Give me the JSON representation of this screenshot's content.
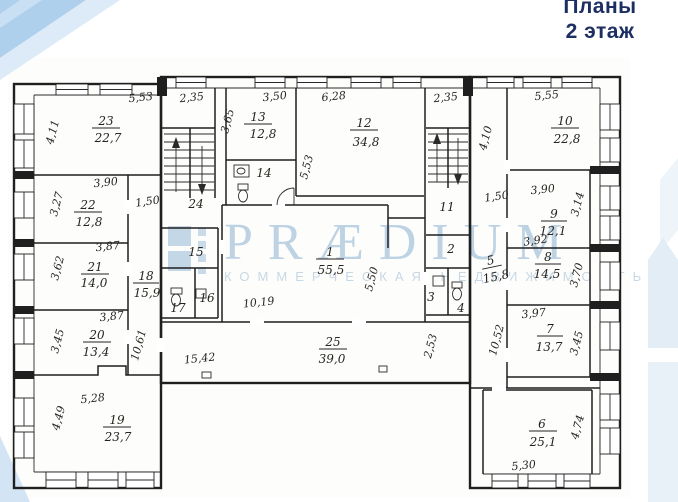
{
  "header": {
    "title_line1": "Планы",
    "title_line2": "2 этаж"
  },
  "watermark": {
    "brand": "PRÆDIUM",
    "subtitle": "КОММЕРЧЕСКАЯ НЕДВИЖИМОСТЬ"
  },
  "colors": {
    "title": "#1d2e63",
    "watermark": "#b3cbdf",
    "plan_lines": "#1f1f1f",
    "ribbon": "#aed0ec"
  },
  "plan": {
    "floor_label": "2 этаж",
    "rooms": {
      "r1": {
        "number": "1",
        "area": "55,5"
      },
      "r2": {
        "number": "2"
      },
      "r3": {
        "number": "3"
      },
      "r4": {
        "number": "4"
      },
      "r5": {
        "number": "5",
        "area": "15,8"
      },
      "r6": {
        "number": "6",
        "area": "25,1"
      },
      "r7": {
        "number": "7",
        "area": "13,7"
      },
      "r8": {
        "number": "8",
        "area": "14,5"
      },
      "r9": {
        "number": "9",
        "area": "12,1"
      },
      "r10": {
        "number": "10",
        "area": "22,8"
      },
      "r11": {
        "number": "11"
      },
      "r12": {
        "number": "12",
        "area": "34,8"
      },
      "r13": {
        "number": "13",
        "area": "12,8"
      },
      "r14": {
        "number": "14"
      },
      "r15": {
        "number": "15"
      },
      "r16": {
        "number": "16"
      },
      "r17": {
        "number": "17"
      },
      "r18": {
        "number": "18",
        "area": "15,9"
      },
      "r19": {
        "number": "19",
        "area": "23,7"
      },
      "r20": {
        "number": "20",
        "area": "13,4"
      },
      "r21": {
        "number": "21",
        "area": "14,0"
      },
      "r22": {
        "number": "22",
        "area": "12,8"
      },
      "r23": {
        "number": "23",
        "area": "22,7"
      },
      "r24": {
        "number": "24"
      },
      "r25": {
        "number": "25",
        "area": "39,0"
      }
    },
    "dims": {
      "r23_top": "5,53",
      "r23_left": "4,11",
      "r22_top": "3,90",
      "r22_left": "3,27",
      "corr_left_width": "1,50",
      "r21_top": "3,87",
      "r21_left": "3,62",
      "r20_top": "3,87",
      "r20_left": "3,45",
      "corr_left_length": "10,61",
      "r19_top": "5,28",
      "r19_left": "4,49",
      "stair_left": "2,35",
      "r13_top": "3,50",
      "r13_left": "3,65",
      "r12_top": "6,28",
      "r12_left": "5,53",
      "r1_bottom": "10,19",
      "r1_right": "5,50",
      "corr25_left": "15,42",
      "corr25_height": "2,53",
      "stair_right": "2,35",
      "r10_top": "5,55",
      "r10_left": "4,10",
      "corr_right_width": "1,50",
      "r9_top": "3,90",
      "r9_right": "3,14",
      "r8_top": "3,92",
      "r8_right": "3,70",
      "r7_top": "3,97",
      "r7_right": "3,45",
      "corr_right_length": "10,52",
      "r6_bottom": "5,30",
      "r6_right": "4,74"
    }
  }
}
